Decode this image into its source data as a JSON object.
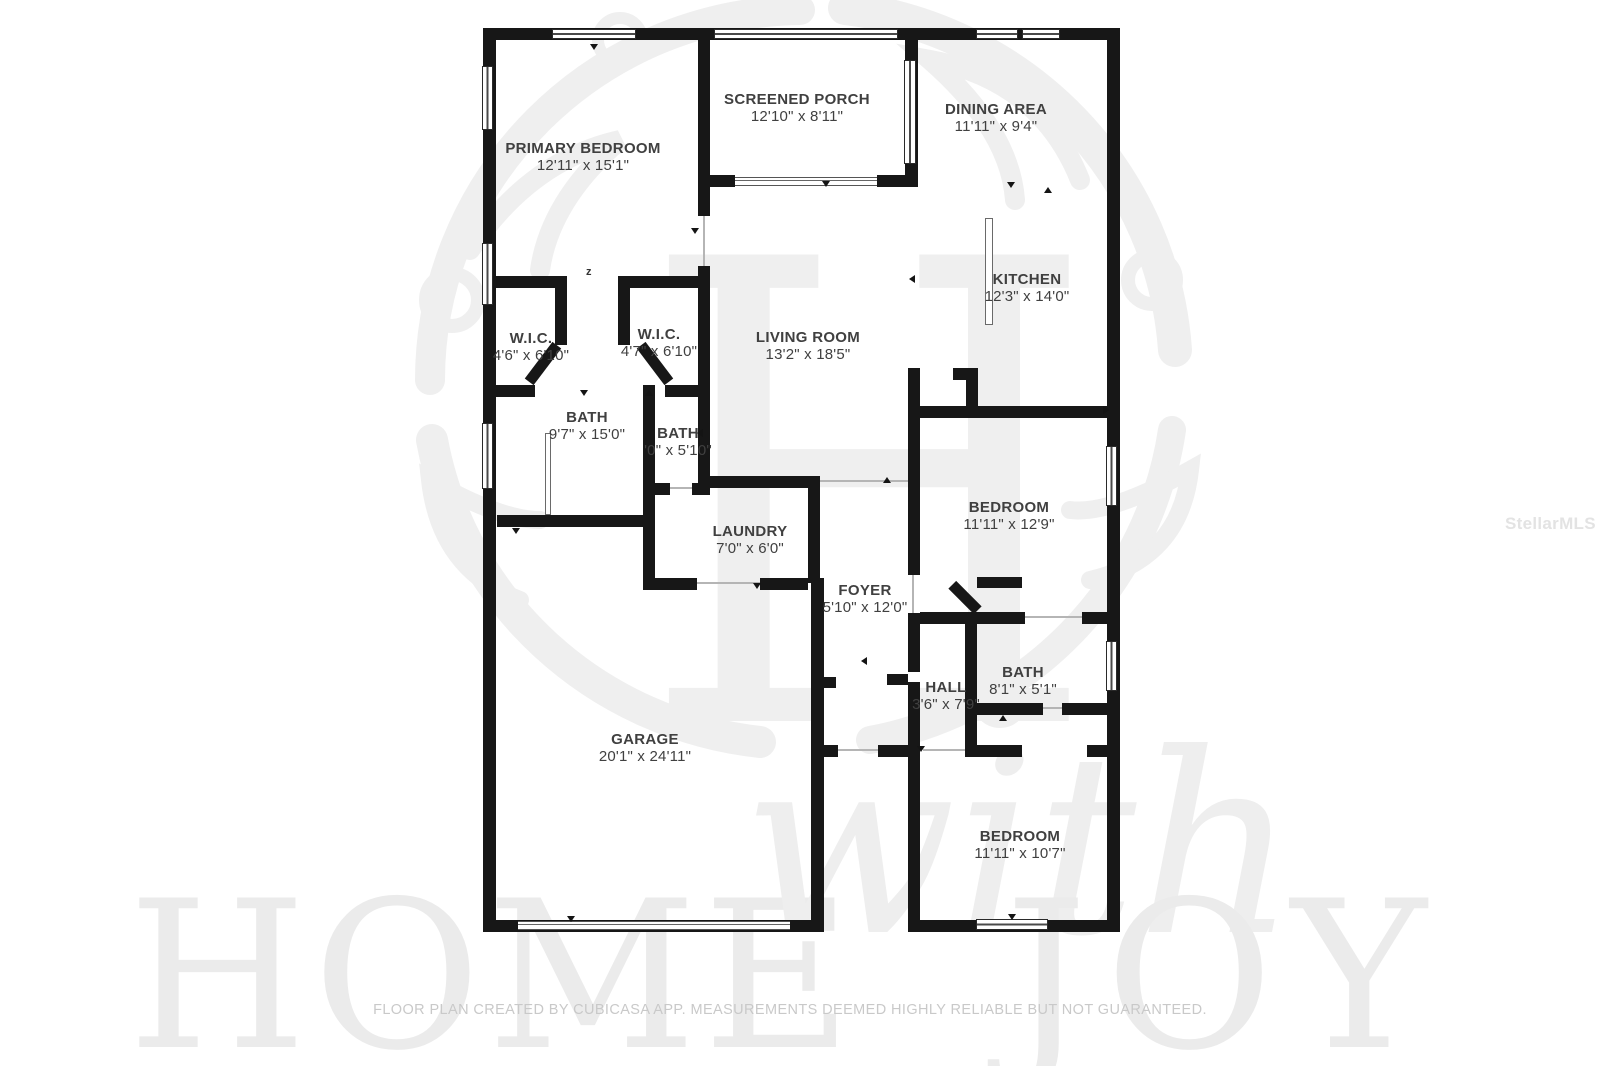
{
  "branding": {
    "center_monogram": "H",
    "bottom_watermark_word1": "HOME",
    "bottom_watermark_word2": "with",
    "bottom_watermark_word3": "JOY",
    "mls_watermark": "StellarMLS",
    "watermark_color": "#ebebeb"
  },
  "footer": {
    "text": "FLOOR PLAN CREATED BY CUBICASA APP. MEASUREMENTS DEEMED HIGHLY RELIABLE BUT NOT GUARANTEED."
  },
  "floor_plan": {
    "wall_color": "#171717",
    "label_color": "#404040",
    "door_swing_mark": "z",
    "rooms": [
      {
        "id": "screened-porch",
        "name": "SCREENED PORCH",
        "dims": "12'10\" x 8'11\"",
        "cx": 797,
        "cy": 108
      },
      {
        "id": "dining-area",
        "name": "DINING AREA",
        "dims": "11'11\" x 9'4\"",
        "cx": 996,
        "cy": 118
      },
      {
        "id": "primary-bedroom",
        "name": "PRIMARY BEDROOM",
        "dims": "12'11\" x 15'1\"",
        "cx": 583,
        "cy": 157
      },
      {
        "id": "kitchen",
        "name": "KITCHEN",
        "dims": "12'3\" x 14'0\"",
        "cx": 1027,
        "cy": 288
      },
      {
        "id": "wic-left",
        "name": "W.I.C.",
        "dims": "4'6\" x 6'10\"",
        "cx": 531,
        "cy": 347
      },
      {
        "id": "wic-right",
        "name": "W.I.C.",
        "dims": "4'7\" x 6'10\"",
        "cx": 659,
        "cy": 343
      },
      {
        "id": "living-room",
        "name": "LIVING ROOM",
        "dims": "13'2\" x 18'5\"",
        "cx": 808,
        "cy": 346
      },
      {
        "id": "primary-bath",
        "name": "BATH",
        "dims": "9'7\" x 15'0\"",
        "cx": 587,
        "cy": 426
      },
      {
        "id": "bath-2",
        "name": "BATH",
        "dims": "'0\" x 5'10\"",
        "cx": 678,
        "cy": 442
      },
      {
        "id": "laundry",
        "name": "LAUNDRY",
        "dims": "7'0\" x 6'0\"",
        "cx": 750,
        "cy": 540
      },
      {
        "id": "foyer",
        "name": "FOYER",
        "dims": "5'10\" x 12'0\"",
        "cx": 865,
        "cy": 599
      },
      {
        "id": "bedroom-mid",
        "name": "BEDROOM",
        "dims": "11'11\" x 12'9\"",
        "cx": 1009,
        "cy": 516
      },
      {
        "id": "hall",
        "name": "HALL",
        "dims": "3'6\" x 7'9\"",
        "cx": 946,
        "cy": 696
      },
      {
        "id": "bath-3",
        "name": "BATH",
        "dims": "8'1\" x 5'1\"",
        "cx": 1023,
        "cy": 681
      },
      {
        "id": "garage",
        "name": "GARAGE",
        "dims": "20'1\" x 24'11\"",
        "cx": 645,
        "cy": 748
      },
      {
        "id": "bedroom-bottom",
        "name": "BEDROOM",
        "dims": "11'11\" x 10'7\"",
        "cx": 1020,
        "cy": 845
      }
    ]
  }
}
